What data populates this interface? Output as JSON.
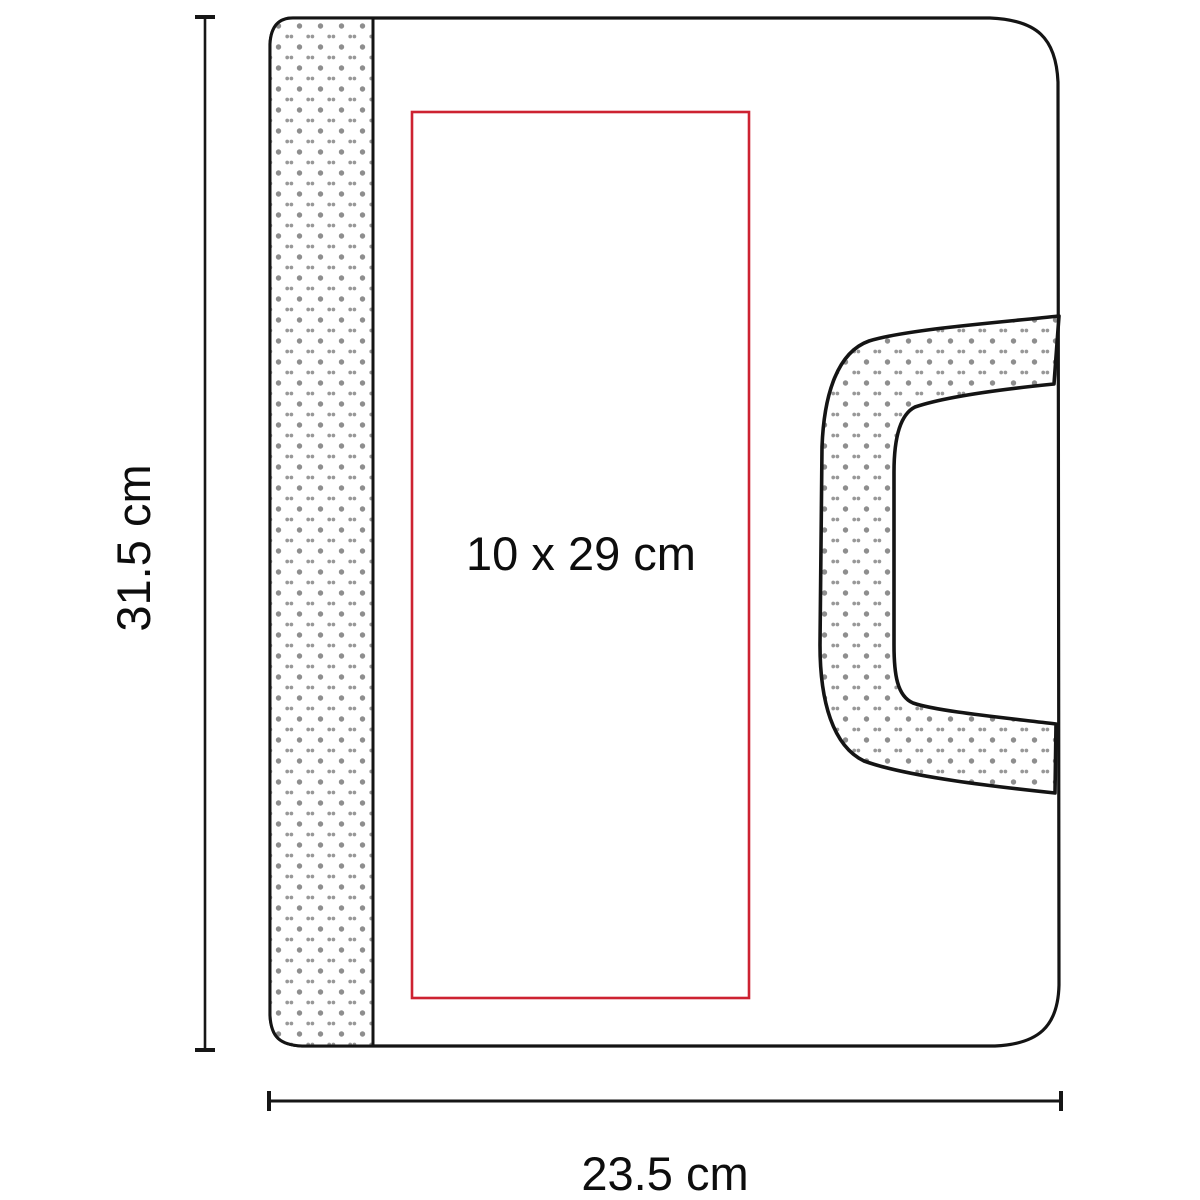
{
  "diagram": {
    "type": "product-dimension-diagram",
    "product": "portfolio bag with handle",
    "print_area_label": "10 x 29 cm",
    "height_label": "31.5 cm",
    "width_label": "23.5 cm"
  },
  "colors": {
    "outline": "#141414",
    "print_area_border": "#cd2231",
    "pattern_dot": "#8e8e8e",
    "background": "#ffffff"
  }
}
